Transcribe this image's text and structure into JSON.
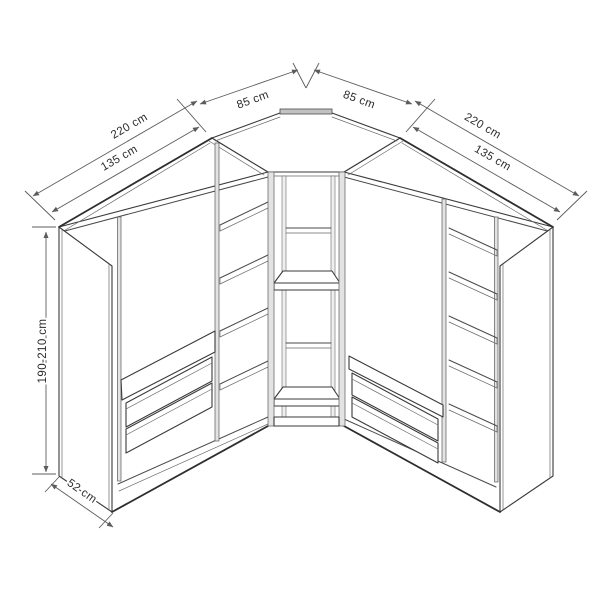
{
  "diagram": {
    "subject": "corner-wardrobe-technical-drawing",
    "units": "cm"
  },
  "colors": {
    "background": "#ffffff",
    "line": "#3a3a3a",
    "dimension_line": "#5c5c5c",
    "panel_fill": "#e3e3e3",
    "panel_edge_fill": "#c2c2c2"
  },
  "dimensions": {
    "left_total_width": "220 cm",
    "left_unit_width": "135 cm",
    "left_corner_back_width": "85 cm",
    "right_corner_back_width": "85 cm",
    "right_total_width": "220 cm",
    "right_unit_width": "135 cm",
    "height_range": "190-210 cm",
    "depth": "52 cm"
  }
}
